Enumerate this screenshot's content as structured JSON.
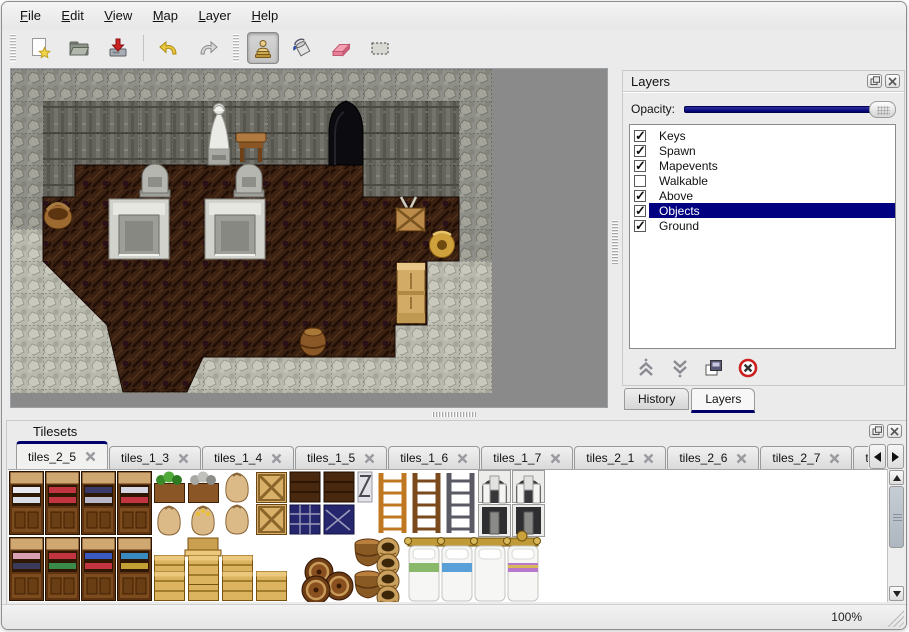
{
  "menu": {
    "items": [
      {
        "label": "File"
      },
      {
        "label": "Edit"
      },
      {
        "label": "View"
      },
      {
        "label": "Map"
      },
      {
        "label": "Layer"
      },
      {
        "label": "Help"
      }
    ]
  },
  "toolbar": {
    "tools": [
      {
        "name": "new-file",
        "active": false
      },
      {
        "name": "open",
        "active": false
      },
      {
        "name": "save",
        "active": false
      },
      {
        "name": "undo",
        "active": false
      },
      {
        "name": "redo",
        "active": false
      },
      {
        "name": "stamp-tool",
        "active": true
      },
      {
        "name": "fill-tool",
        "active": false
      },
      {
        "name": "eraser-tool",
        "active": false
      },
      {
        "name": "select-tool",
        "active": false
      }
    ]
  },
  "layers_panel": {
    "title": "Layers",
    "opacity_label": "Opacity:",
    "opacity_percent": 100,
    "items": [
      {
        "label": "Keys",
        "checked": true,
        "selected": false
      },
      {
        "label": "Spawn",
        "checked": true,
        "selected": false
      },
      {
        "label": "Mapevents",
        "checked": true,
        "selected": false
      },
      {
        "label": "Walkable",
        "checked": false,
        "selected": false
      },
      {
        "label": "Above",
        "checked": true,
        "selected": false
      },
      {
        "label": "Objects",
        "checked": true,
        "selected": true
      },
      {
        "label": "Ground",
        "checked": true,
        "selected": false
      }
    ],
    "action_icons": [
      "move-layer-up",
      "move-layer-down",
      "duplicate-layer",
      "delete-layer"
    ],
    "tabs": [
      {
        "label": "History",
        "active": false
      },
      {
        "label": "Layers",
        "active": true
      }
    ]
  },
  "tilesets_panel": {
    "title": "Tilesets",
    "tabs": [
      {
        "label": "tiles_2_5",
        "active": true
      },
      {
        "label": "tiles_1_3",
        "active": false
      },
      {
        "label": "tiles_1_4",
        "active": false
      },
      {
        "label": "tiles_1_5",
        "active": false
      },
      {
        "label": "tiles_1_6",
        "active": false
      },
      {
        "label": "tiles_1_7",
        "active": false
      },
      {
        "label": "tiles_2_1",
        "active": false
      },
      {
        "label": "tiles_2_6",
        "active": false
      },
      {
        "label": "tiles_2_7",
        "active": false
      },
      {
        "label": "tiles_",
        "active": false
      }
    ]
  },
  "status_bar": {
    "zoom_level": "100%"
  },
  "colors": {
    "selection_navy": "#000080",
    "accent_navy": "#00006a"
  }
}
